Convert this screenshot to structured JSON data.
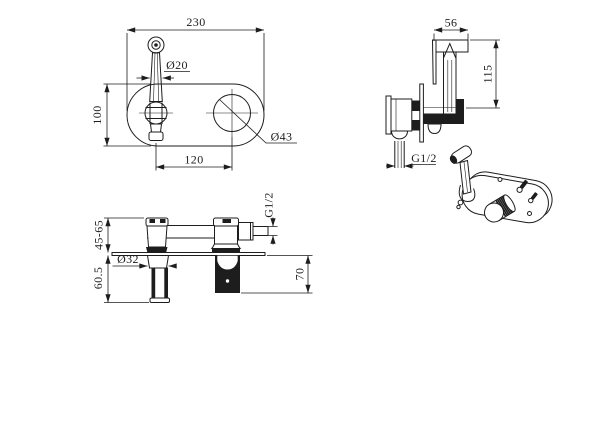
{
  "drawing": {
    "background": "#ffffff",
    "ink": "#1d1d1d",
    "views": {
      "top": {
        "label": "plate-top-view",
        "dims": {
          "plate_width": "230",
          "lever_diameter": "Ø20",
          "plate_height": "100",
          "hole_spacing": "120",
          "knob_diameter": "Ø43"
        }
      },
      "side": {
        "label": "sprayer-side-view",
        "dims": {
          "head_width": "56",
          "sprayer_height": "115",
          "inlet_thread": "G1/2"
        }
      },
      "front": {
        "label": "valve-front-section-view",
        "dims": {
          "mounting_depth": "45-65",
          "handle_projection": "60.5",
          "handle_diameter": "Ø32",
          "outlet_thread": "G1/2",
          "spout_projection": "70"
        }
      },
      "perspective": {
        "label": "assembled-3d-view"
      }
    }
  }
}
